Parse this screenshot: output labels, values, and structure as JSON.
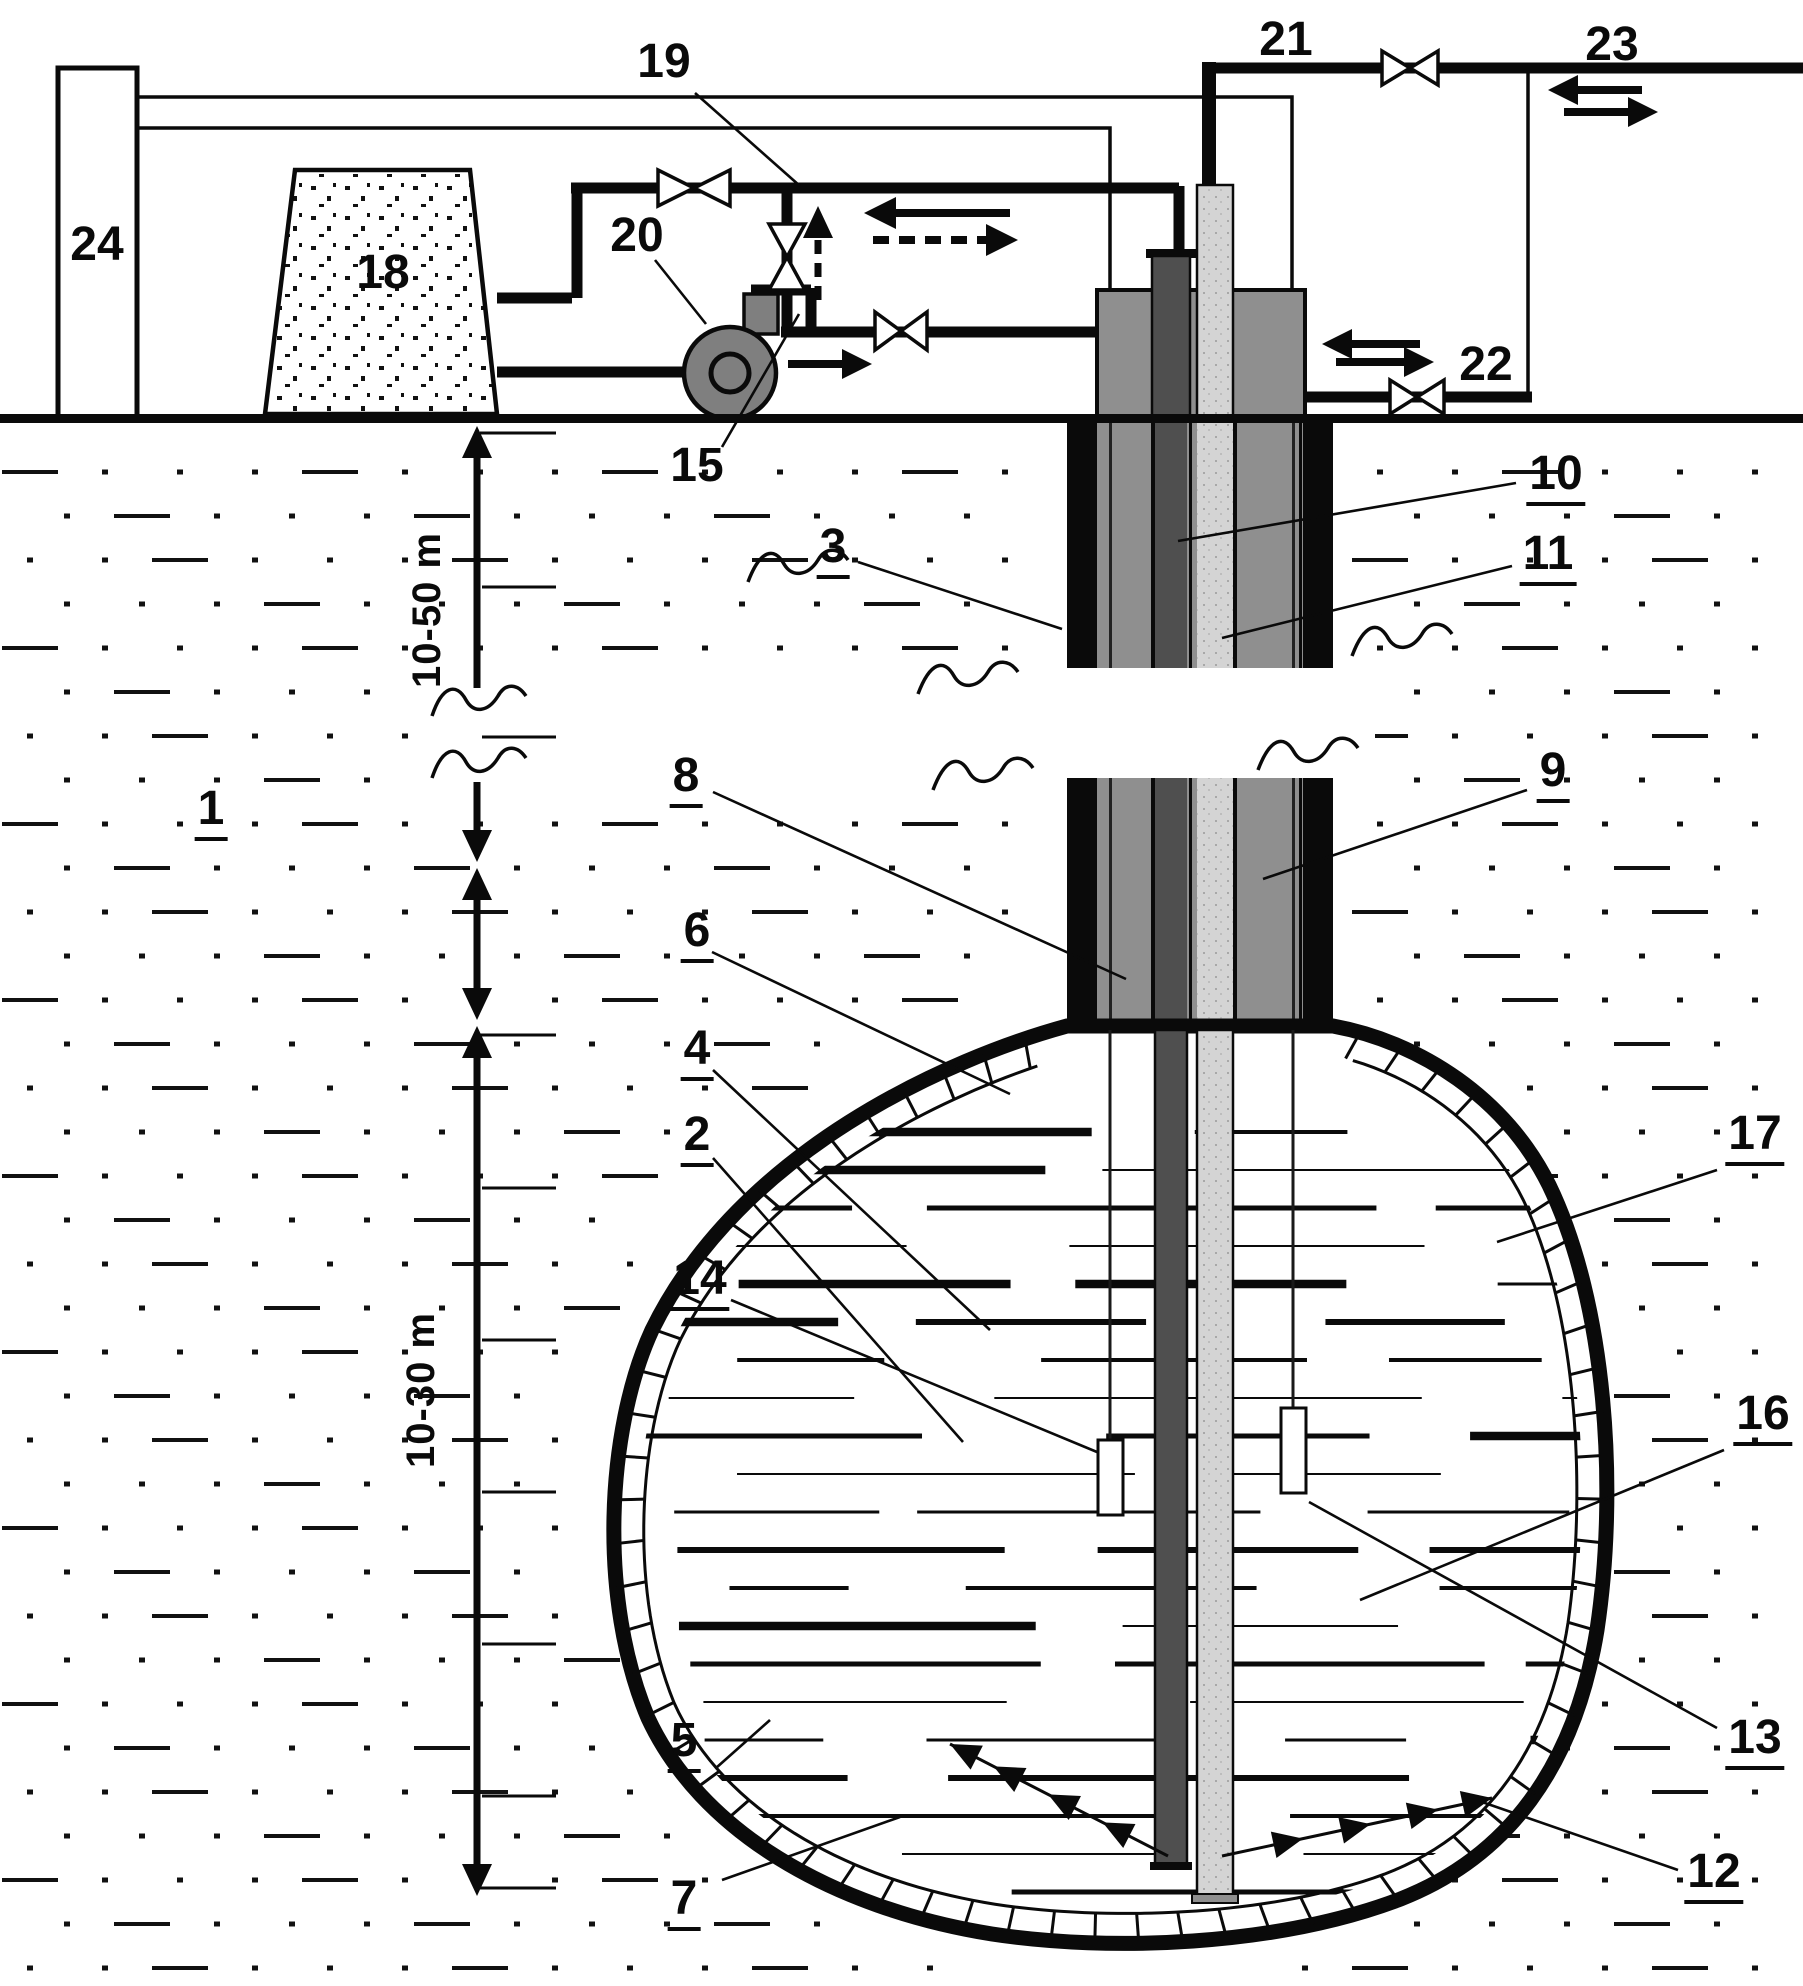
{
  "figure": {
    "type": "patent-style cross-section diagram of underground cavern thermal/gas storage with borehole and surface plant",
    "colors": {
      "line": "#0a0a0a",
      "annulus_gray": "#8f8f8f",
      "dark_pipe": "#4f4f4f",
      "light_pipe": "#d4d4d4",
      "pump_gray": "#7f7f7f",
      "background": "#ffffff"
    }
  },
  "labels": [
    {
      "text": "24",
      "x": 97,
      "y": 245,
      "u": false
    },
    {
      "text": "18",
      "x": 383,
      "y": 273,
      "u": false
    },
    {
      "text": "19",
      "x": 664,
      "y": 62,
      "u": false
    },
    {
      "text": "20",
      "x": 637,
      "y": 236,
      "u": false
    },
    {
      "text": "15",
      "x": 697,
      "y": 466,
      "u": false
    },
    {
      "text": "21",
      "x": 1286,
      "y": 40,
      "u": false
    },
    {
      "text": "23",
      "x": 1612,
      "y": 45,
      "u": false
    },
    {
      "text": "22",
      "x": 1486,
      "y": 365,
      "u": false
    },
    {
      "text": "10",
      "x": 1556,
      "y": 478,
      "u": true
    },
    {
      "text": "11",
      "x": 1548,
      "y": 558,
      "u": true
    },
    {
      "text": "3",
      "x": 833,
      "y": 551,
      "u": true
    },
    {
      "text": "8",
      "x": 686,
      "y": 780,
      "u": true
    },
    {
      "text": "9",
      "x": 1553,
      "y": 775,
      "u": true
    },
    {
      "text": "6",
      "x": 697,
      "y": 935,
      "u": true
    },
    {
      "text": "4",
      "x": 697,
      "y": 1053,
      "u": true
    },
    {
      "text": "2",
      "x": 697,
      "y": 1139,
      "u": true
    },
    {
      "text": "14",
      "x": 700,
      "y": 1283,
      "u": true
    },
    {
      "text": "17",
      "x": 1755,
      "y": 1138,
      "u": true
    },
    {
      "text": "16",
      "x": 1763,
      "y": 1418,
      "u": true
    },
    {
      "text": "13",
      "x": 1755,
      "y": 1742,
      "u": true
    },
    {
      "text": "12",
      "x": 1714,
      "y": 1876,
      "u": true
    },
    {
      "text": "5",
      "x": 684,
      "y": 1745,
      "u": true
    },
    {
      "text": "7",
      "x": 684,
      "y": 1903,
      "u": true
    },
    {
      "text": "1",
      "x": 211,
      "y": 813,
      "u": true
    },
    {
      "text": "10-50 m",
      "x": 427,
      "y": 610,
      "u": false,
      "rot": true
    },
    {
      "text": "10-30 m",
      "x": 421,
      "y": 1390,
      "u": false,
      "rot": true
    }
  ]
}
